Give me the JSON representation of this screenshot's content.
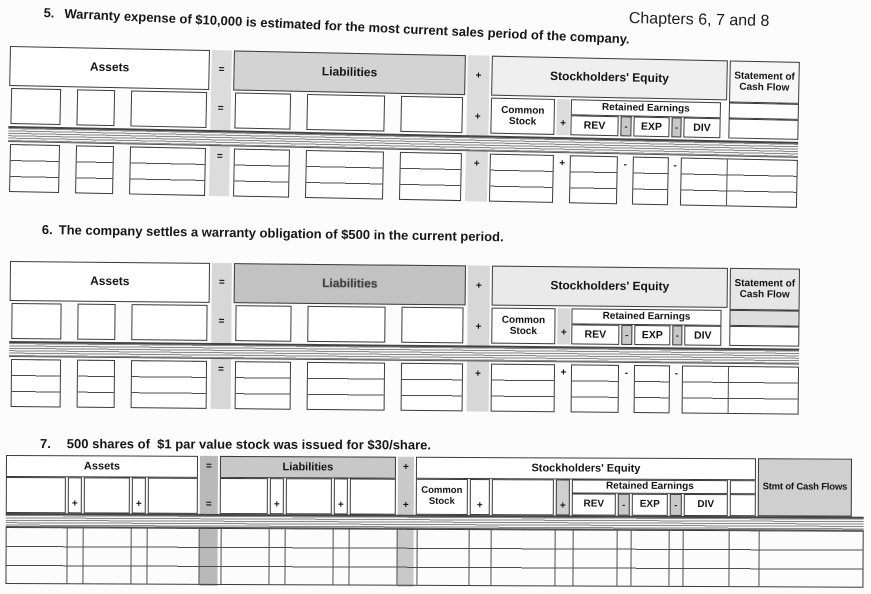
{
  "header": {
    "chapters": "Chapters 6, 7 and 8"
  },
  "problems": [
    {
      "number": "5.",
      "text": "Warranty expense of $10,000 is estimated for the most current sales period of the company."
    },
    {
      "number": "6.",
      "text": "The company settles a warranty obligation of $500 in the current period."
    },
    {
      "number": "7.",
      "text": "500 shares of  $1 par value stock was issued for $30/share."
    }
  ],
  "labels": {
    "assets": "Assets",
    "liabilities": "Liabilities",
    "equity": "Stockholders' Equity",
    "cash_flow_long": "Statement of Cash Flow",
    "cash_flow_short": "Stmt of Cash Flows",
    "common_stock": "Common Stock",
    "retained_earnings": "Retained Earnings",
    "rev": "REV",
    "exp": "EXP",
    "div": "DIV",
    "equals": "=",
    "plus": "+",
    "minus": "-"
  },
  "colors": {
    "border": "#3b3b3b",
    "liabilities_shade_t5": "#d3d3d3",
    "liabilities_shade_t6": "#c2c2c2",
    "liabilities_shade_t7": "#c8c8c8",
    "equity_shade": "#efefef",
    "cash_flow_shade": "#cfcfcf",
    "connector_shade": "#dcdcdc",
    "equals_strip_t7": "#b9b9b9",
    "minus_cell_shade": "#c8c8c8",
    "hatch_line": "#8a8a8a",
    "page_background": "#fcfcfc"
  }
}
